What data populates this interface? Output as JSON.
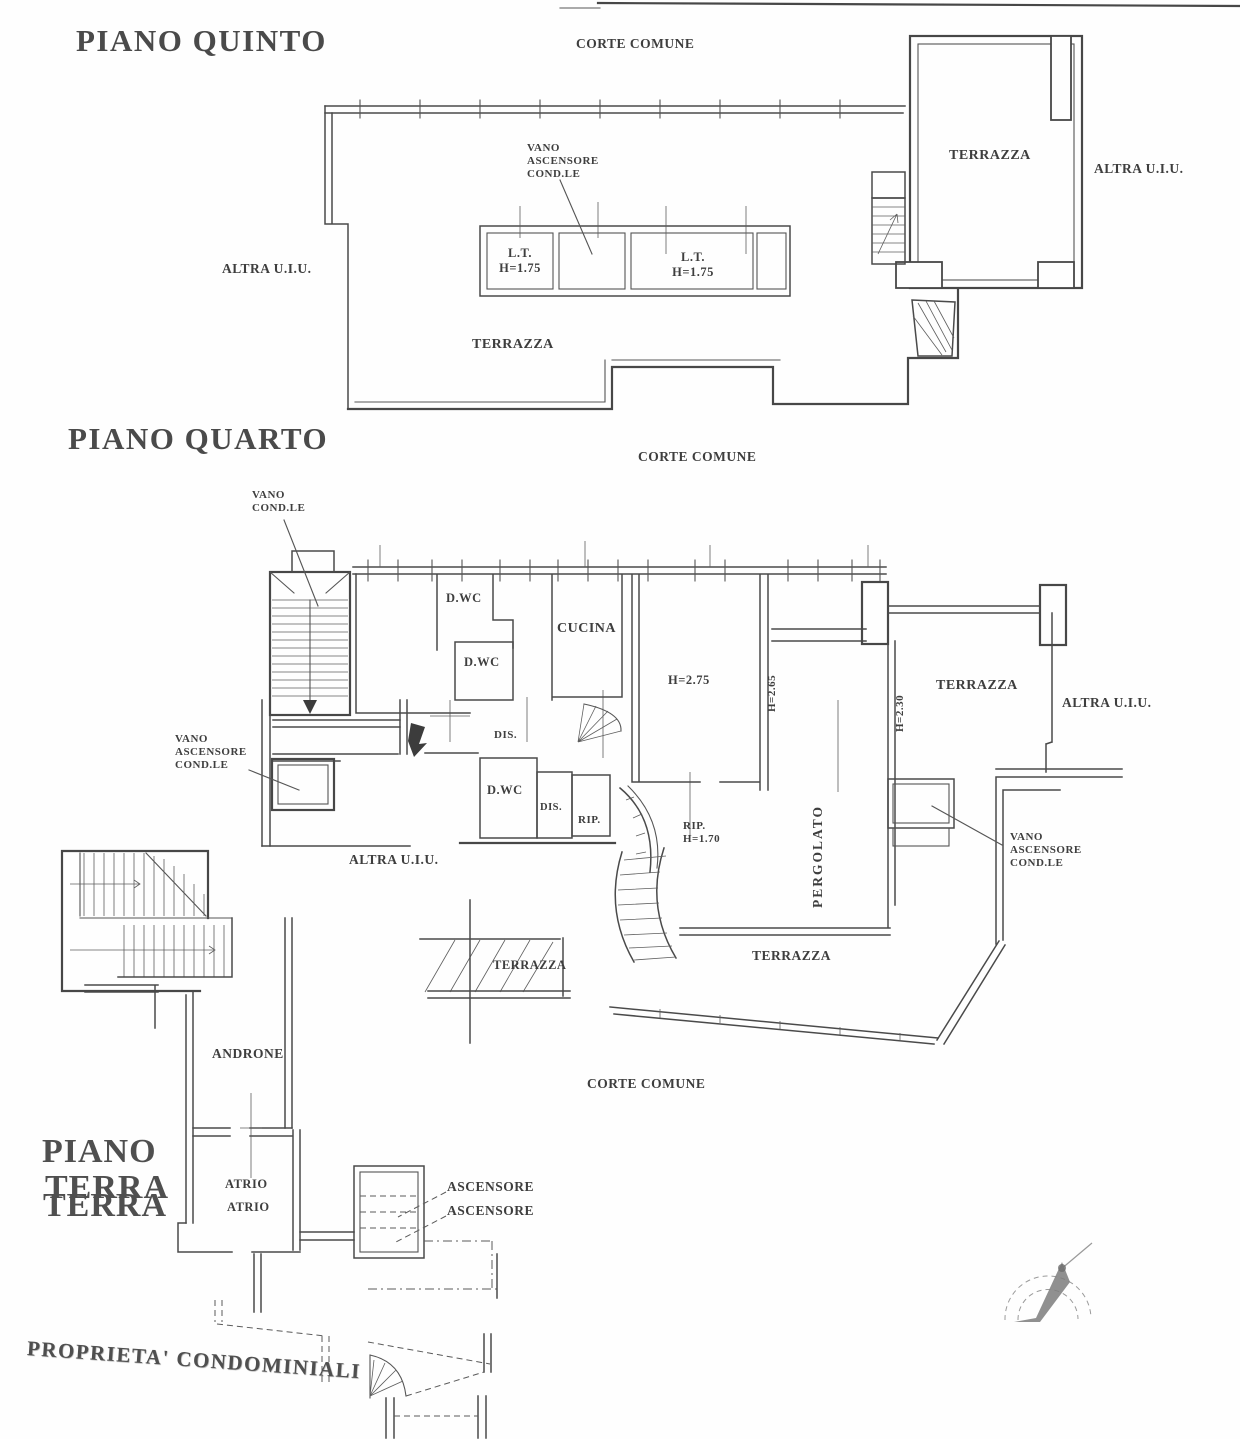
{
  "colors": {
    "ink": "#474747",
    "paper": "#fefefe",
    "compass": "#8a8a8a"
  },
  "piano_quinto": {
    "title": "PIANO QUINTO",
    "corte_comune": "CORTE COMUNE",
    "terrazza_block": "TERRAZZA",
    "altra_uiu_right": "ALTRA U.I.U.",
    "altra_uiu_left": "ALTRA U.I.U.",
    "vano_ascensore": "VANO\nASCENSORE\nCOND.LE",
    "lt_left": "L.T.\nH=1.75",
    "lt_right": "L.T.\nH=1.75",
    "terrazza_main": "TERRAZZA"
  },
  "piano_quarto": {
    "title": "PIANO QUARTO",
    "corte_comune_top": "CORTE COMUNE",
    "vano_condle": "VANO\nCOND.LE",
    "dwc_1": "D.WC",
    "cucina": "CUCINA",
    "dwc_2": "D.WC",
    "h275": "H=2.75",
    "h265": "H=2.65",
    "h230": "H=2.30",
    "pergolato": "PERGOLATO",
    "terrazza_right": "TERRAZZA",
    "altra_uiu_right": "ALTRA U.I.U.",
    "vano_ascensore_left": "VANO\nASCENSORE\nCOND.LE",
    "dis_1": "DIS.",
    "dwc_3": "D.WC",
    "dis_2": "DIS.",
    "rip_1": "RIP.",
    "rip_2": "RIP.\nH=1.70",
    "vano_ascensore_right": "VANO\nASCENSORE\nCOND.LE",
    "altra_uiu_left": "ALTRA U.I.U.",
    "terrazza_small": "TERRAZZA",
    "terrazza_bottom": "TERRAZZA",
    "corte_comune_bottom": "CORTE COMUNE"
  },
  "piano_terra": {
    "title_line1": "PIANO",
    "title_line2": "TERRA",
    "title_line2_ghost": "TERRA",
    "androne": "ANDRONE",
    "atrio_1": "ATRIO",
    "atrio_2": "ATRIO",
    "ascensore_1": "ASCENSORE",
    "ascensore_2": "ASCENSORE",
    "proprieta": "PROPRIETA' CONDOMINIALI"
  }
}
